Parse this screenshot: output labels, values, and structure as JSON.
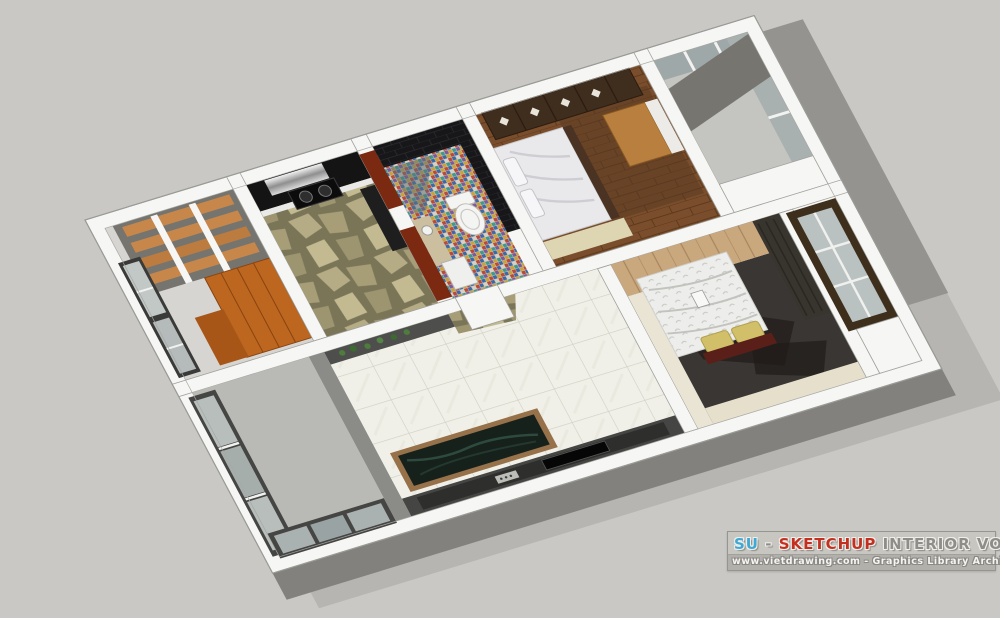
{
  "banner": {
    "line1": {
      "su": "SU",
      "dash": "-",
      "sketchup": "SKETCHUP",
      "rest": "INTERIOR VOL.3"
    },
    "line2": "www.vietdrawing.com - Graphics Library Architecture",
    "colors": {
      "su": "#3fa9d4",
      "sketchup": "#c33020",
      "muted_text": "#8f8d88",
      "line2_text": "#f5f4f1",
      "bar_top": "#c8c6c1",
      "bar_bottom": "#b2b0ab",
      "border": "#97958f"
    }
  },
  "scene": {
    "background": "#c9c8c4",
    "palette": {
      "wall_top_white": "#f6f6f4",
      "wall_face_gray": "#6a6a68",
      "ground_shadow": "#b6b5b1",
      "marble_tile": "#f1f0e8",
      "tile_grout": "#cfcec2",
      "flagstone": "#b5ac86",
      "kitchen_cabinet_dark": "#141414",
      "red_cabinet": "#7c2912",
      "mosaic_blue": "#3a68a8",
      "mosaic_red": "#b84a3a",
      "wood_floor": "#7a4e2c",
      "wardrobe_dark_wood": "#3f2d1e",
      "orange_wardrobe": "#bc661f",
      "headboard_wood": "#c9a87e",
      "bed_white": "#ececea",
      "pillow_gold": "#d2bf6a",
      "glass": "#b7bebc",
      "frame_dark": "#3c3c3a"
    }
  }
}
